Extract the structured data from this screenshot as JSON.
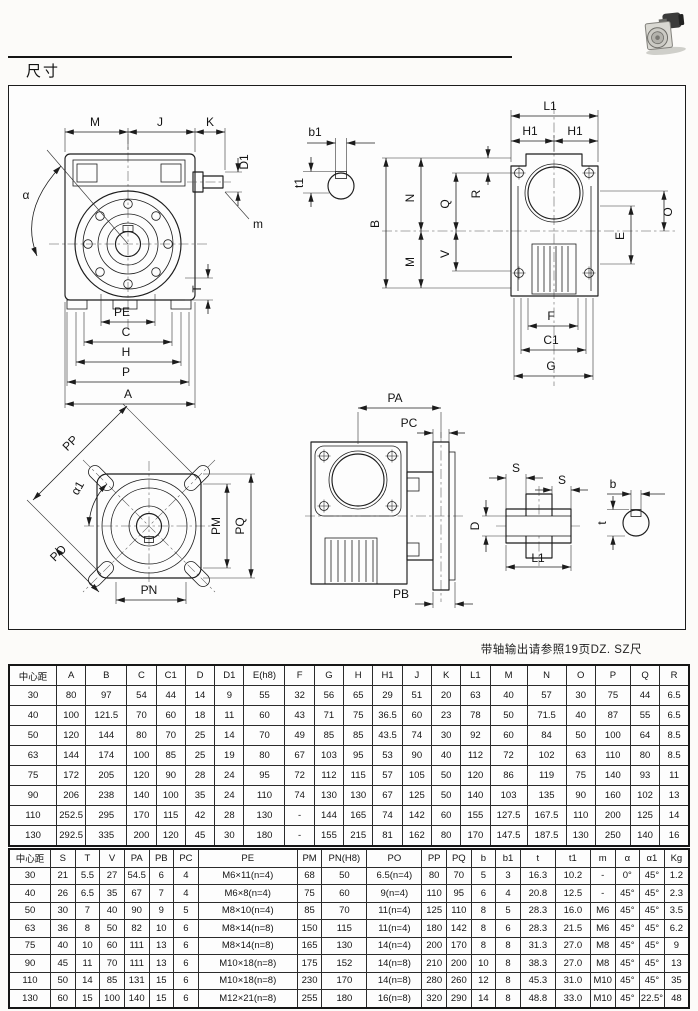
{
  "page": {
    "title": "尺寸",
    "note": "带轴输出请参照19页DZ. SZ尺"
  },
  "drawing_labels": {
    "front_view": {
      "M": "M",
      "J": "J",
      "K": "K",
      "D1": "D1",
      "alpha": "α",
      "m": "m",
      "T": "T",
      "PE": "PE",
      "C": "C",
      "H": "H",
      "P": "P",
      "A": "A"
    },
    "input_key_detail": {
      "b1": "b1",
      "t1": "t1"
    },
    "side_view": {
      "L1": "L1",
      "H1_left": "H1",
      "H1_right": "H1",
      "B": "B",
      "N": "N",
      "Q": "Q",
      "R": "R",
      "M": "M",
      "V": "V",
      "E": "E",
      "O": "O",
      "F": "F",
      "C1": "C1",
      "G": "G"
    },
    "output_flange_view": {
      "PP": "PP",
      "alpha1": "α1",
      "PO": "PO",
      "PN": "PN",
      "PM": "PM",
      "PQ": "PQ"
    },
    "output_side_view": {
      "PA": "PA",
      "PC": "PC",
      "PB": "PB"
    },
    "hollow_shaft_detail": {
      "S_left": "S",
      "S_right": "S",
      "D": "D",
      "L1": "L1",
      "b": "b",
      "t": "t"
    }
  },
  "dimension_table_1": {
    "headers": [
      "中心距",
      "A",
      "B",
      "C",
      "C1",
      "D",
      "D1",
      "E(h8)",
      "F",
      "G",
      "H",
      "H1",
      "J",
      "K",
      "L1",
      "M",
      "N",
      "O",
      "P",
      "Q",
      "R"
    ],
    "rows": [
      [
        "30",
        "80",
        "97",
        "54",
        "44",
        "14",
        "9",
        "55",
        "32",
        "56",
        "65",
        "29",
        "51",
        "20",
        "63",
        "40",
        "57",
        "30",
        "75",
        "44",
        "6.5"
      ],
      [
        "40",
        "100",
        "121.5",
        "70",
        "60",
        "18",
        "11",
        "60",
        "43",
        "71",
        "75",
        "36.5",
        "60",
        "23",
        "78",
        "50",
        "71.5",
        "40",
        "87",
        "55",
        "6.5"
      ],
      [
        "50",
        "120",
        "144",
        "80",
        "70",
        "25",
        "14",
        "70",
        "49",
        "85",
        "85",
        "43.5",
        "74",
        "30",
        "92",
        "60",
        "84",
        "50",
        "100",
        "64",
        "8.5"
      ],
      [
        "63",
        "144",
        "174",
        "100",
        "85",
        "25",
        "19",
        "80",
        "67",
        "103",
        "95",
        "53",
        "90",
        "40",
        "112",
        "72",
        "102",
        "63",
        "110",
        "80",
        "8.5"
      ],
      [
        "75",
        "172",
        "205",
        "120",
        "90",
        "28",
        "24",
        "95",
        "72",
        "112",
        "115",
        "57",
        "105",
        "50",
        "120",
        "86",
        "119",
        "75",
        "140",
        "93",
        "11"
      ],
      [
        "90",
        "206",
        "238",
        "140",
        "100",
        "35",
        "24",
        "110",
        "74",
        "130",
        "130",
        "67",
        "125",
        "50",
        "140",
        "103",
        "135",
        "90",
        "160",
        "102",
        "13"
      ],
      [
        "110",
        "252.5",
        "295",
        "170",
        "115",
        "42",
        "28",
        "130",
        "-",
        "144",
        "165",
        "74",
        "142",
        "60",
        "155",
        "127.5",
        "167.5",
        "110",
        "200",
        "125",
        "14"
      ],
      [
        "130",
        "292.5",
        "335",
        "200",
        "120",
        "45",
        "30",
        "180",
        "-",
        "155",
        "215",
        "81",
        "162",
        "80",
        "170",
        "147.5",
        "187.5",
        "130",
        "250",
        "140",
        "16"
      ]
    ]
  },
  "dimension_table_2": {
    "headers": [
      "中心距",
      "S",
      "T",
      "V",
      "PA",
      "PB",
      "PC",
      "PE",
      "PM",
      "PN(H8)",
      "PO",
      "PP",
      "PQ",
      "b",
      "b1",
      "t",
      "t1",
      "m",
      "α",
      "α1",
      "Kg"
    ],
    "rows": [
      [
        "30",
        "21",
        "5.5",
        "27",
        "54.5",
        "6",
        "4",
        "M6×11(n=4)",
        "68",
        "50",
        "6.5(n=4)",
        "80",
        "70",
        "5",
        "3",
        "16.3",
        "10.2",
        "-",
        "0°",
        "45°",
        "1.2"
      ],
      [
        "40",
        "26",
        "6.5",
        "35",
        "67",
        "7",
        "4",
        "M6×8(n=4)",
        "75",
        "60",
        "9(n=4)",
        "110",
        "95",
        "6",
        "4",
        "20.8",
        "12.5",
        "-",
        "45°",
        "45°",
        "2.3"
      ],
      [
        "50",
        "30",
        "7",
        "40",
        "90",
        "9",
        "5",
        "M8×10(n=4)",
        "85",
        "70",
        "11(n=4)",
        "125",
        "110",
        "8",
        "5",
        "28.3",
        "16.0",
        "M6",
        "45°",
        "45°",
        "3.5"
      ],
      [
        "63",
        "36",
        "8",
        "50",
        "82",
        "10",
        "6",
        "M8×14(n=8)",
        "150",
        "115",
        "11(n=4)",
        "180",
        "142",
        "8",
        "6",
        "28.3",
        "21.5",
        "M6",
        "45°",
        "45°",
        "6.2"
      ],
      [
        "75",
        "40",
        "10",
        "60",
        "111",
        "13",
        "6",
        "M8×14(n=8)",
        "165",
        "130",
        "14(n=4)",
        "200",
        "170",
        "8",
        "8",
        "31.3",
        "27.0",
        "M8",
        "45°",
        "45°",
        "9"
      ],
      [
        "90",
        "45",
        "11",
        "70",
        "111",
        "13",
        "6",
        "M10×18(n=8)",
        "175",
        "152",
        "14(n=8)",
        "210",
        "200",
        "10",
        "8",
        "38.3",
        "27.0",
        "M8",
        "45°",
        "45°",
        "13"
      ],
      [
        "110",
        "50",
        "14",
        "85",
        "131",
        "15",
        "6",
        "M10×18(n=8)",
        "230",
        "170",
        "14(n=8)",
        "280",
        "260",
        "12",
        "8",
        "45.3",
        "31.0",
        "M10",
        "45°",
        "45°",
        "35"
      ],
      [
        "130",
        "60",
        "15",
        "100",
        "140",
        "15",
        "6",
        "M12×21(n=8)",
        "255",
        "180",
        "16(n=8)",
        "320",
        "290",
        "14",
        "8",
        "48.8",
        "33.0",
        "M10",
        "45°",
        "22.5°",
        "48"
      ]
    ]
  }
}
